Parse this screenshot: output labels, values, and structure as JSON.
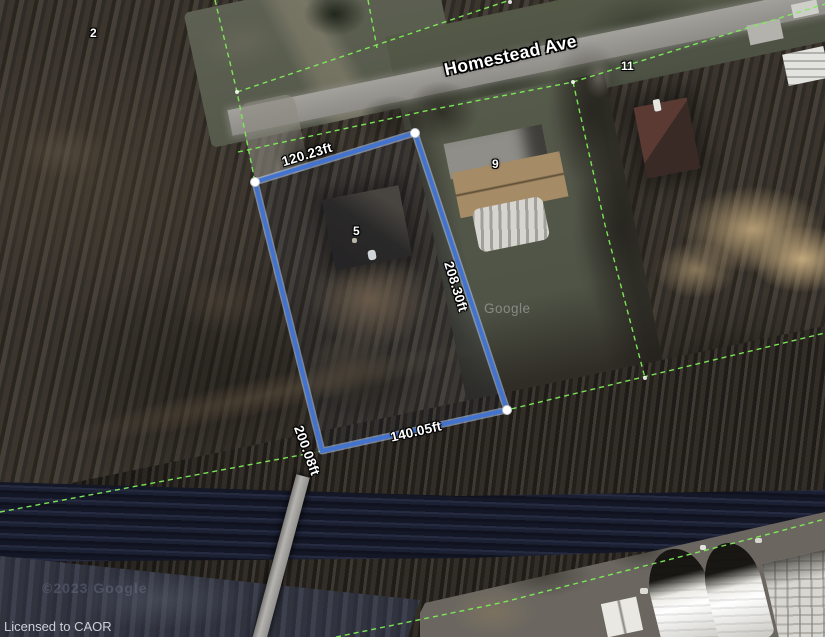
{
  "map": {
    "street_label": "Homestead Ave",
    "license_text": "Licensed to CAOR",
    "watermark_center": "Google",
    "watermark_copyright": "©2023 Google",
    "parcel_numbers": [
      {
        "text": "2"
      },
      {
        "text": "5"
      },
      {
        "text": "9"
      },
      {
        "text": "11"
      }
    ],
    "measurements": {
      "top": "120.23ft",
      "right": "208.30ft",
      "bottom": "140.05ft",
      "left": "200.08ft"
    },
    "colors": {
      "boundary_blue": "#4273cf",
      "boundary_glow": "#b9cdf0",
      "parcel_line_green": "#7dee57",
      "vertex_white": "#ffffff"
    }
  }
}
